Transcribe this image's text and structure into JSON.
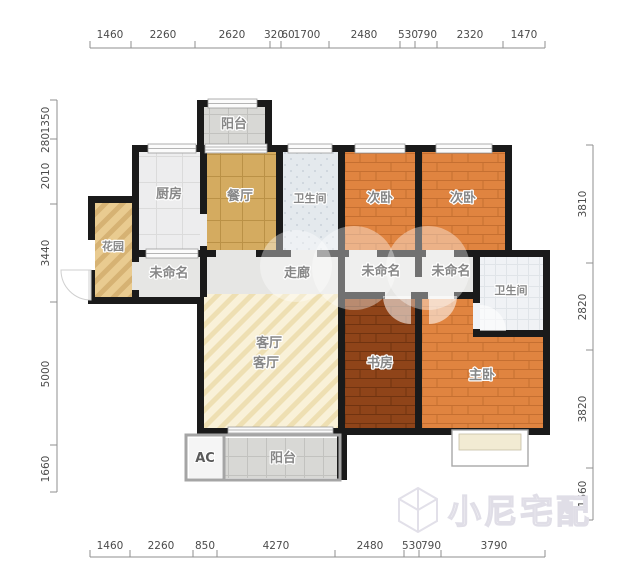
{
  "dimensions": {
    "top": [
      "1460",
      "2260",
      "2620",
      "320",
      "60",
      "1700",
      "2480",
      "530",
      "790",
      "2320",
      "1470"
    ],
    "bottom": [
      "1460",
      "2260",
      "850",
      "4270",
      "2480",
      "530",
      "790",
      "3790"
    ],
    "left": [
      "1350",
      "280",
      "2010",
      "3440",
      "5000",
      "1660"
    ],
    "right": [
      "3810",
      "2820",
      "3820",
      "1660"
    ]
  },
  "rooms": {
    "balcony_top": "阳台",
    "kitchen": "厨房",
    "dining": "餐厅",
    "bathroom_top": "卫生间",
    "bedroom_second_left": "次卧",
    "bedroom_second_right": "次卧",
    "garden": "花园",
    "unnamed_left": "未命名",
    "corridor": "走廊",
    "unnamed_middle": "未命名",
    "unnamed_right": "未命名",
    "bathroom_right": "卫生间",
    "living_upper_label": "客厅",
    "living_lower_label": "客厅",
    "study": "书房",
    "master_bedroom": "主卧",
    "ac": "AC",
    "balcony_bottom": "阳台"
  },
  "watermark": {
    "brand": "小尼宅配"
  },
  "colors": {
    "wall": "#1a1a1a",
    "wood_orange": "#e08440",
    "wood_dark": "#8f4419",
    "tile_gold": "#d4ab60",
    "tile_gray": "#d8d8d5",
    "bath_blue": "#e4e9ed",
    "bath_tile": "#f0f2f5",
    "living_cream": "#f9f1d8",
    "garden_tan": "#e9cb90",
    "corridor_gray": "#e6e6e4",
    "dim_text": "#4b4b4b",
    "label_gray": "#878787",
    "watermark_outline": "#e0dee7"
  }
}
